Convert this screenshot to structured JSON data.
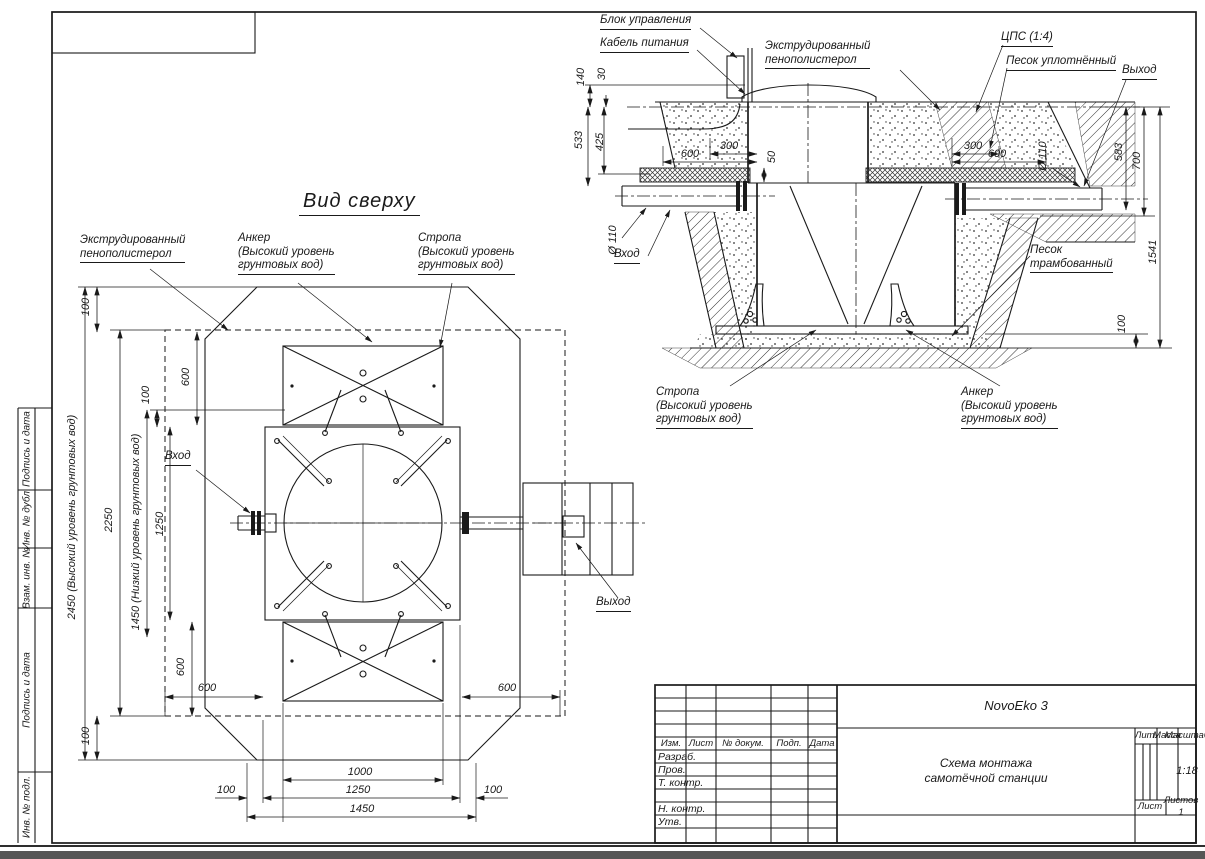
{
  "sheet": {
    "margin_cells": [
      "Подпись и дата",
      "Инв. № дубл.",
      "Взам. инв. №",
      "Подпись и дата",
      "Инв. № подл."
    ]
  },
  "top_view": {
    "title": "Вид сверху",
    "labels": {
      "foam": "Экструдированный\nпенополистерол",
      "anchor": "Анкер\n(Высокий уровень\nгрунтовых вод)",
      "sling": "Стропа\n(Высокий уровень\nгрунтовых вод)",
      "inlet": "Вход",
      "outlet": "Выход"
    },
    "dims": {
      "top_100": "100",
      "left_600": "600",
      "mid_100": "100",
      "total_2450": "2450 (Высокий уровень грунтовых вод)",
      "total_2250": "2250",
      "level_1450": "1450 (Низкий уровень грунтовых вод)",
      "left_1250": "1250",
      "bottom_left_100": "100",
      "bottom_600_v": "600",
      "bottom_left_600": "600",
      "bottom_right_600": "600",
      "bottom_100_left": "100",
      "bottom_1000": "1000",
      "bottom_1250": "1250",
      "bottom_100_right": "100",
      "bottom_1450": "1450"
    }
  },
  "section_view": {
    "labels": {
      "control_unit": "Блок управления",
      "power_cable": "Кабель питания",
      "foam": "Экструдированный\nпенополистерол",
      "cps": "ЦПС (1:4)",
      "sand_compacted": "Песок уплотнённый",
      "outlet": "Выход",
      "inlet": "Вход",
      "sand_rammed": "Песок\nтрамбованный",
      "sling": "Стропа\n(Высокий уровень\nгрунтовых вод)",
      "anchor": "Анкер\n(Высокий уровень\nгрунтовых вод)"
    },
    "dims": {
      "h140": "140",
      "h30": "30",
      "h533": "533",
      "h425": "425",
      "left_600": "600",
      "left_300": "300",
      "h50": "50",
      "right_300": "300",
      "right_600": "600",
      "dia_inlet": "Ø 110",
      "dia_outlet": "Ø 110",
      "h583": "583",
      "h700": "700",
      "h1541": "1541",
      "bed_100": "100"
    }
  },
  "title_block": {
    "product": "NovoEko 3",
    "doc_title": "Схема монтажа\nсамотёчной станции",
    "columns": {
      "izm": "Изм.",
      "list": "Лист",
      "doc": "№ докум.",
      "podp": "Подп.",
      "data": "Дата"
    },
    "rows": {
      "razrab": "Разраб.",
      "prov": "Пров.",
      "t_kontr": "Т. контр.",
      "n_kontr": "Н. контр.",
      "utv": "Утв."
    },
    "right": {
      "lit": "Лит.",
      "mass": "Масса",
      "scale_lbl": "Масштаб",
      "scale": "1:18",
      "sheet": "Лист",
      "sheets": "Листов 1"
    }
  }
}
